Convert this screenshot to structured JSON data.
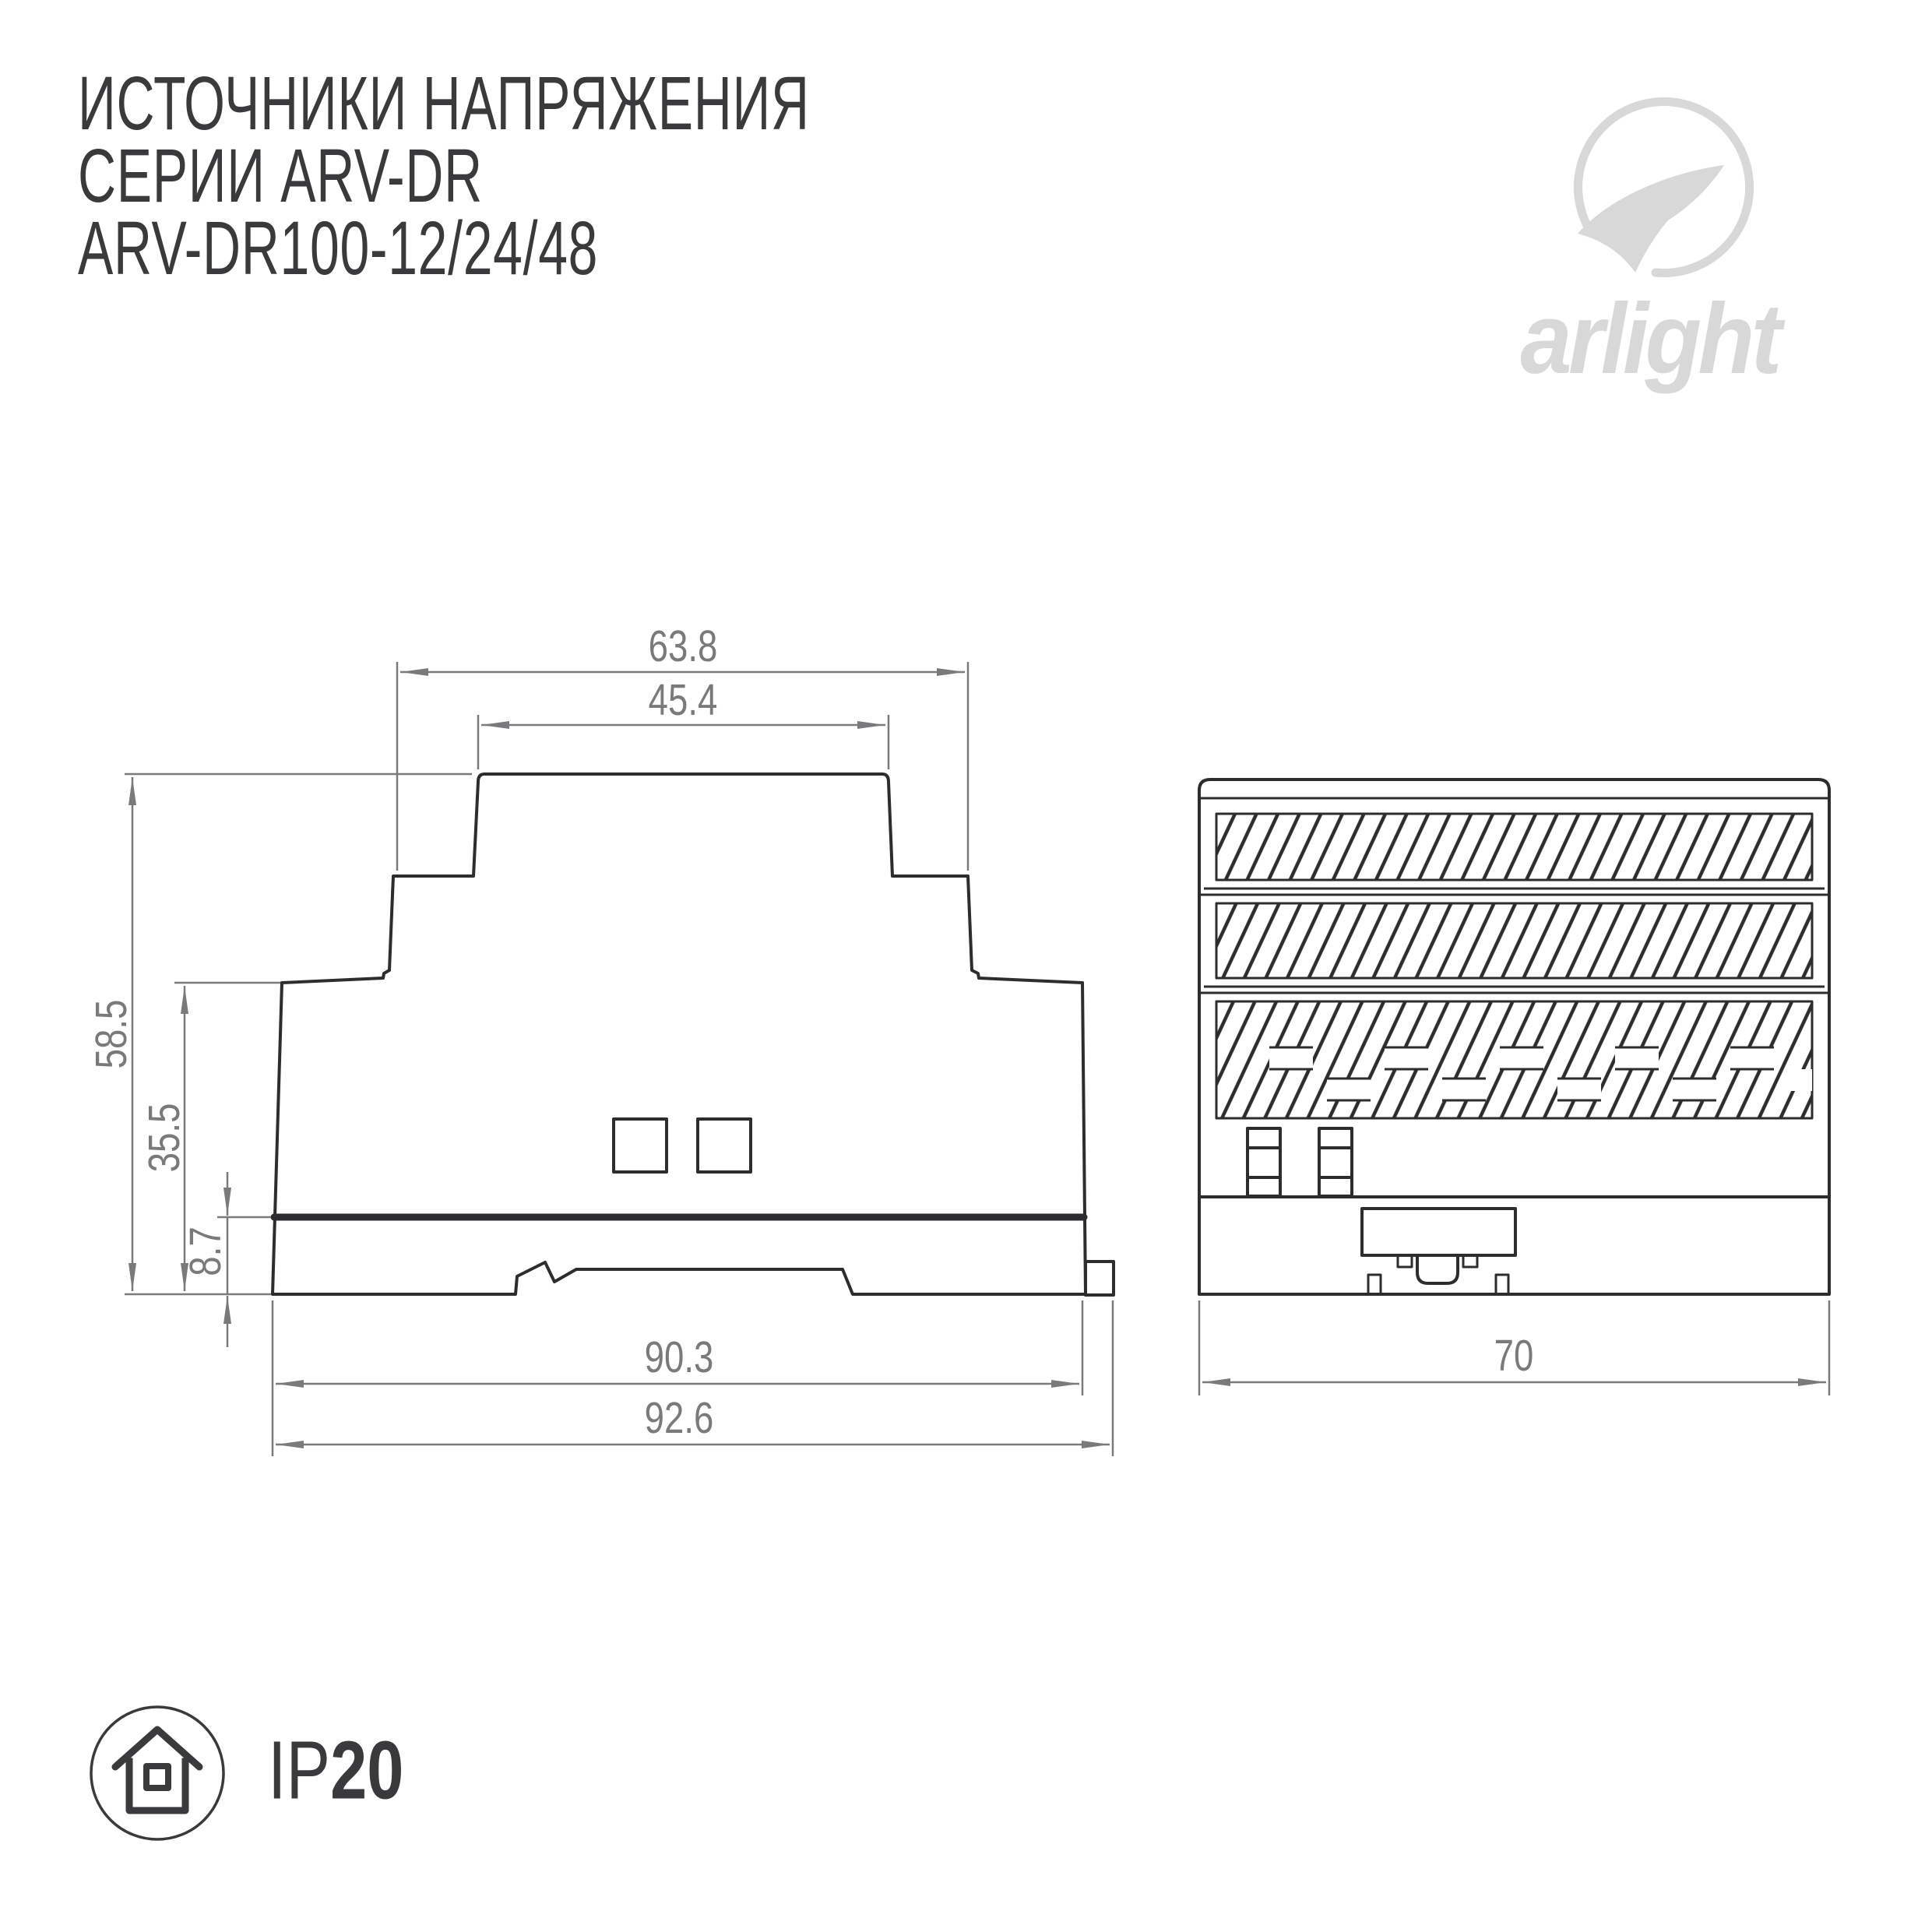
{
  "header": {
    "title_line1": "ИСТОЧНИКИ НАПРЯЖЕНИЯ",
    "title_line2": "СЕРИИ ARV-DR",
    "title_line3": "ARV-DR100-12/24/48"
  },
  "logo": {
    "brand": "arlight",
    "color": "#d8d8d8"
  },
  "colors": {
    "outline": "#2d2d2f",
    "dimension": "#7a7a7d",
    "text": "#3a3a3c",
    "background": "#ffffff"
  },
  "side_view": {
    "name": "side view drawing",
    "dims": {
      "top_outer_width": "63.8",
      "top_inner_width": "45.4",
      "height_total": "58.5",
      "height_body": "35.5",
      "height_base": "8.7",
      "width_body": "90.3",
      "width_total": "92.6"
    }
  },
  "front_view": {
    "name": "front view drawing",
    "dims": {
      "width": "70"
    }
  },
  "badge": {
    "ip_prefix": "IP",
    "ip_value": "20"
  }
}
